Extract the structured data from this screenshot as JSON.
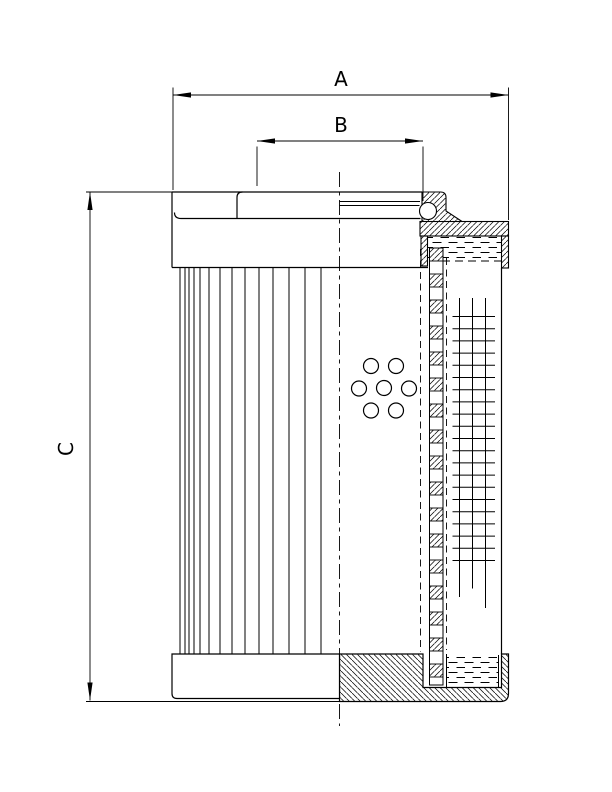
{
  "colors": {
    "background": "#ffffff",
    "ink": "#000000"
  },
  "dimension_labels": {
    "a": "A",
    "b": "B",
    "c": "C"
  }
}
